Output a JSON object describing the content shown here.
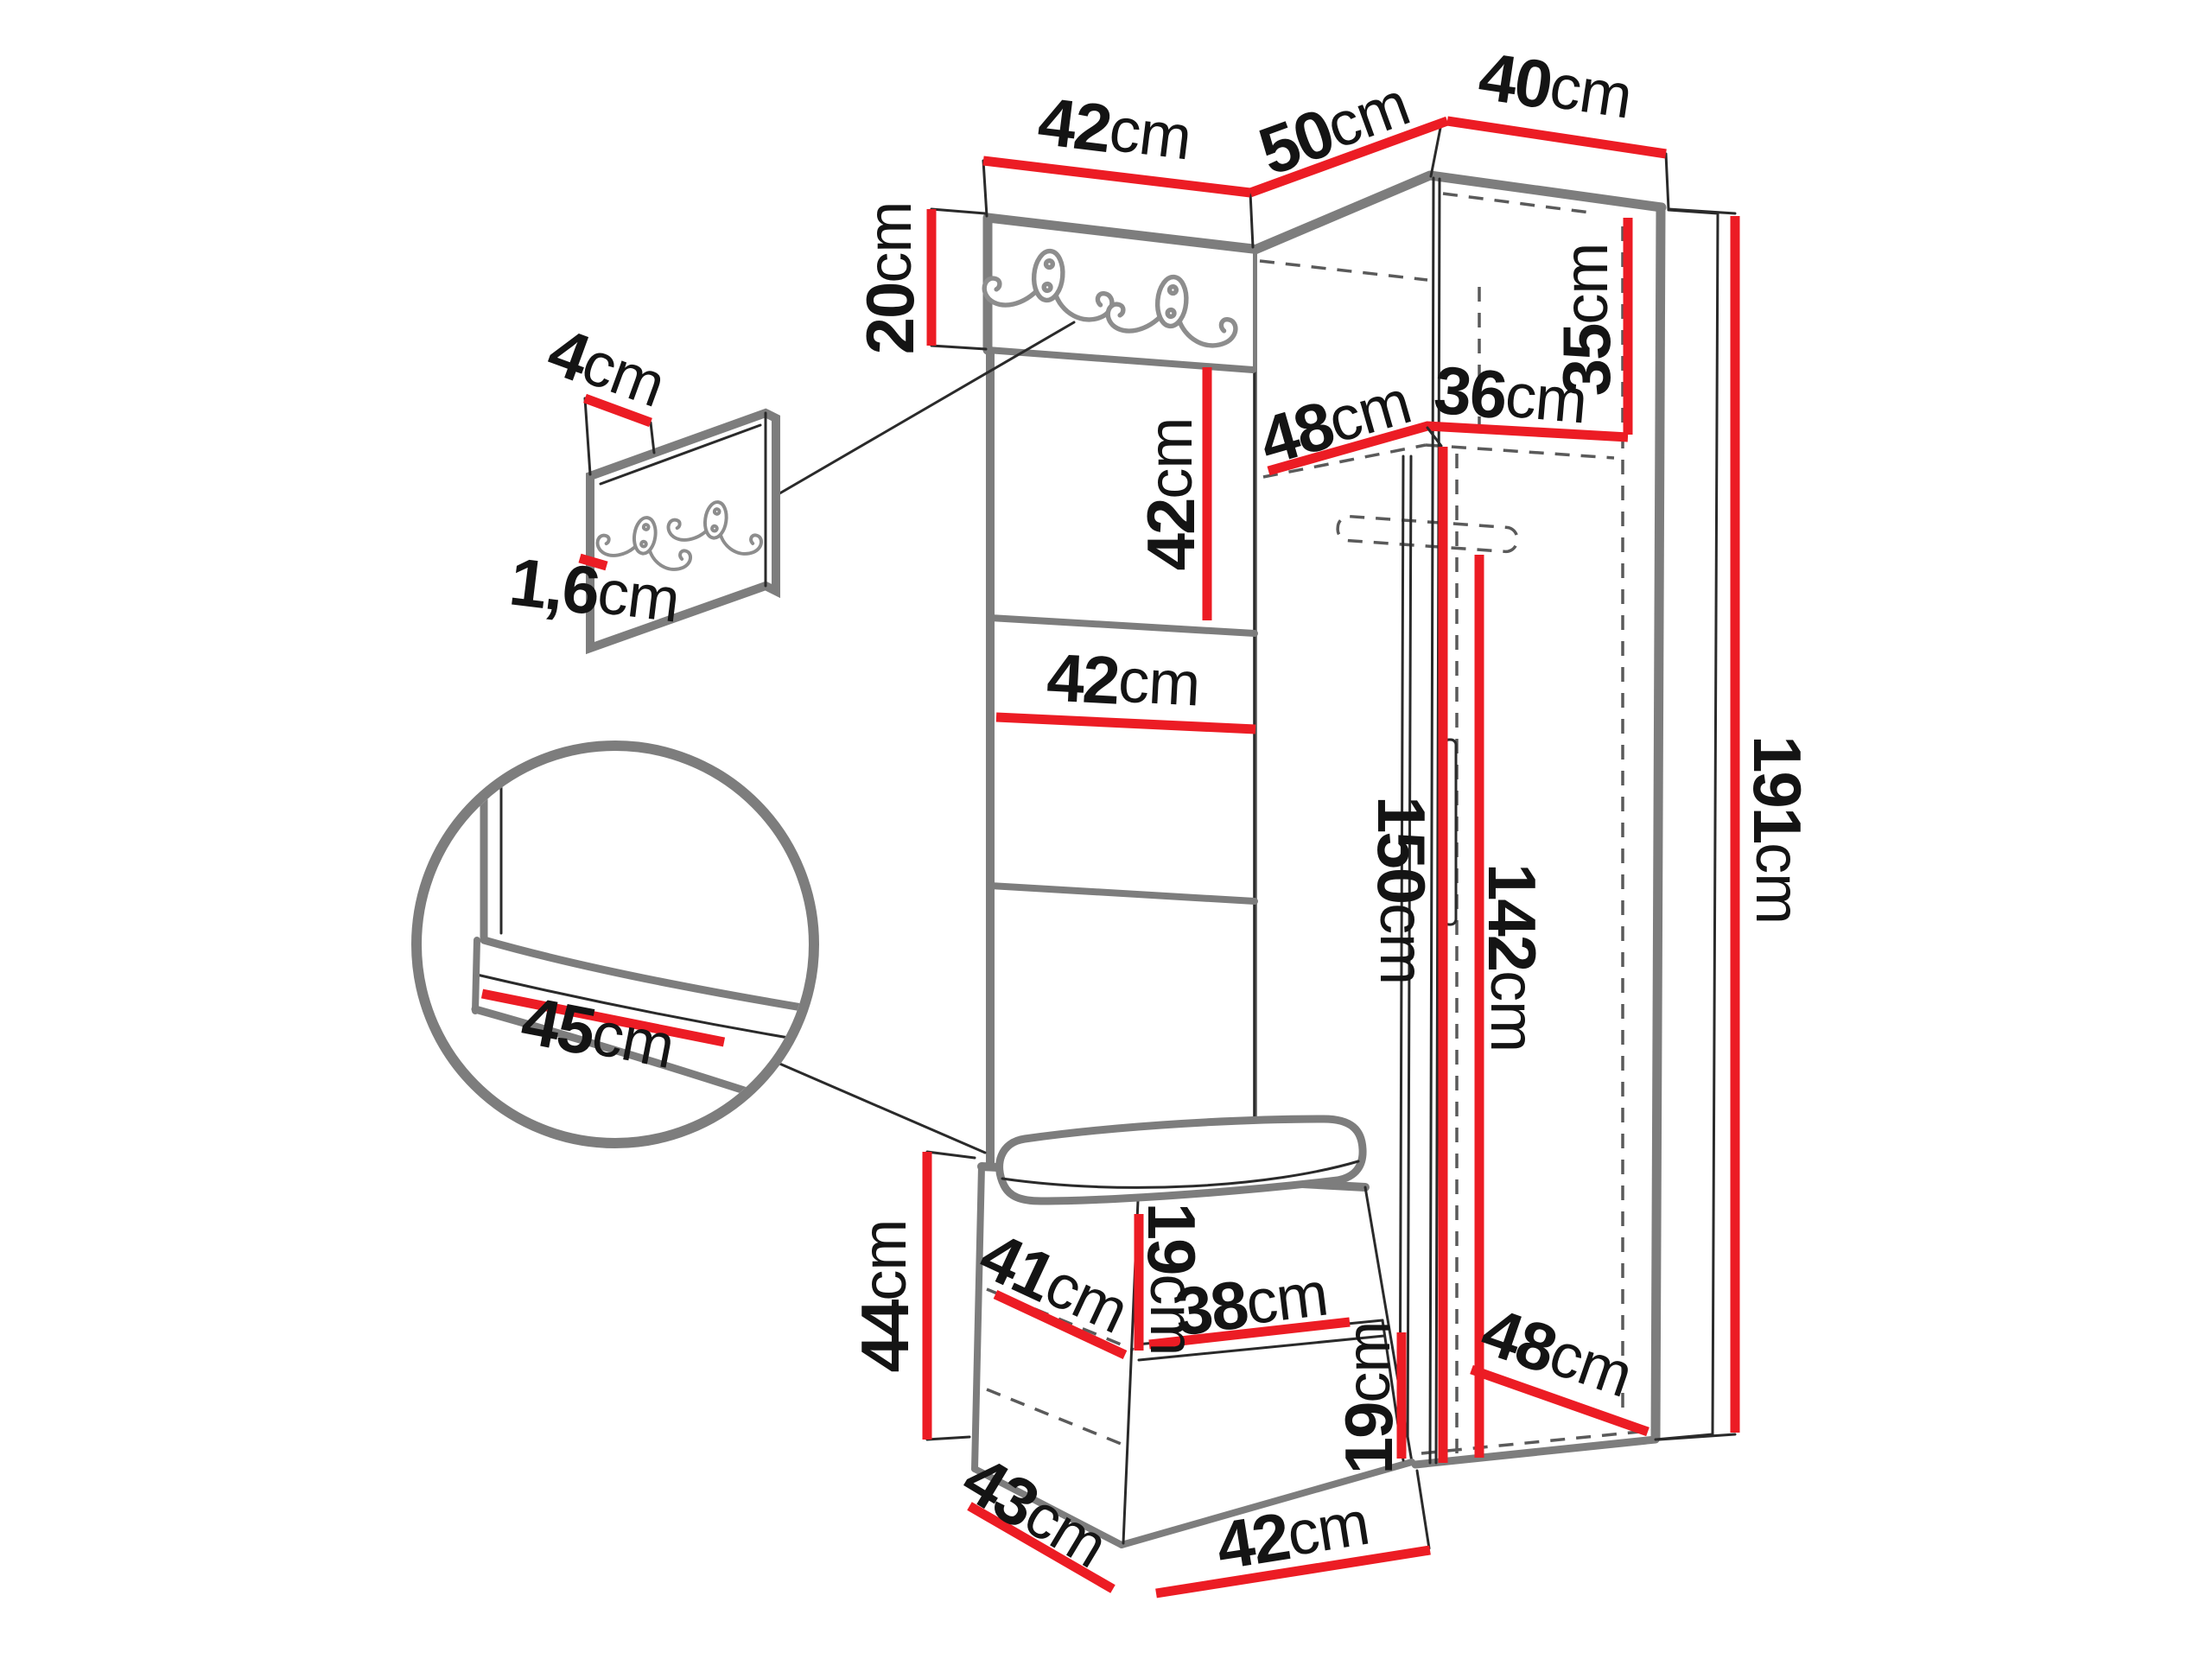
{
  "diagram": {
    "kind": "furniture-dimension-diagram",
    "subject": "hallway set: corner wardrobe with open top shelf, coat-hook panel column and storage bench",
    "unit": "cm",
    "accent_color": "#ec1c24",
    "outline_color": "#7d7d7d",
    "icons": {
      "coat_hook": "double-coat-hook-icon"
    },
    "dims": {
      "top_panel_width": {
        "value": "42",
        "unit": "cm"
      },
      "corner_left_depth": {
        "value": "50",
        "unit": "cm"
      },
      "wardrobe_top_width": {
        "value": "40",
        "unit": "cm"
      },
      "hook_board_height": {
        "value": "20",
        "unit": "cm"
      },
      "wall_panel_depth": {
        "value": "4",
        "unit": "cm"
      },
      "wall_panel_thickness": {
        "value": "1,6",
        "unit": "cm"
      },
      "upholstered_panel_height": {
        "value": "42",
        "unit": "cm"
      },
      "shelf_depth": {
        "value": "48",
        "unit": "cm"
      },
      "shelf_width": {
        "value": "36",
        "unit": "cm"
      },
      "top_compartment_height": {
        "value": "35",
        "unit": "cm"
      },
      "upholstered_panel_width": {
        "value": "42",
        "unit": "cm"
      },
      "bench_cushion_depth": {
        "value": "45",
        "unit": "cm"
      },
      "open_section_height": {
        "value": "150",
        "unit": "cm"
      },
      "door_height": {
        "value": "142",
        "unit": "cm"
      },
      "total_height": {
        "value": "191",
        "unit": "cm"
      },
      "bench_height": {
        "value": "44",
        "unit": "cm"
      },
      "bench_shelf_depth": {
        "value": "41",
        "unit": "cm"
      },
      "bench_upper_compartment_height": {
        "value": "19",
        "unit": "cm"
      },
      "bench_shelf_width": {
        "value": "38",
        "unit": "cm"
      },
      "bench_bottom_width": {
        "value": "42",
        "unit": "cm"
      },
      "bench_lower_compartment_height": {
        "value": "19",
        "unit": "cm"
      },
      "bench_bottom_depth": {
        "value": "43",
        "unit": "cm"
      },
      "wardrobe_bottom_depth": {
        "value": "48",
        "unit": "cm"
      }
    }
  }
}
